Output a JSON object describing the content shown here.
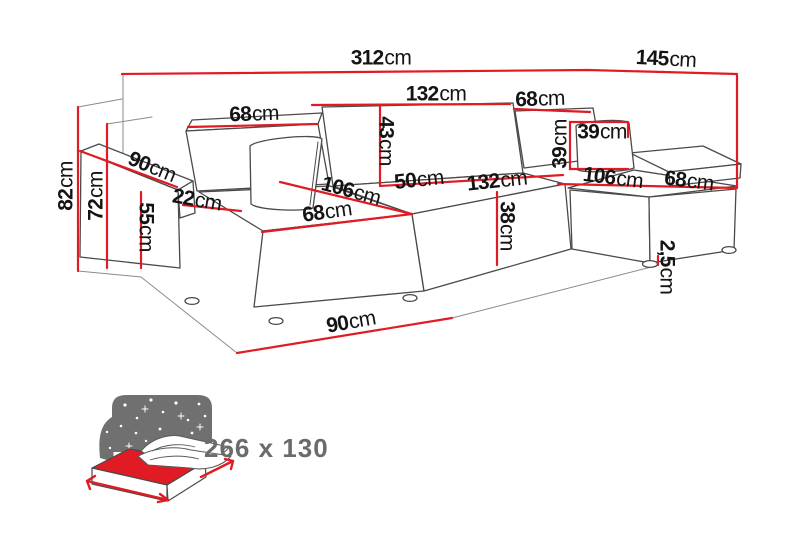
{
  "diagram": {
    "title": "corner-sofa-dimension-diagram",
    "unit_default": "cm",
    "labels": [
      {
        "id": "total-width",
        "value": "312",
        "unit": "cm",
        "x": 381,
        "y": 58,
        "rotate": 0
      },
      {
        "id": "total-depth-right",
        "value": "145",
        "unit": "cm",
        "x": 666,
        "y": 59,
        "rotate": 3
      },
      {
        "id": "back-cushion-middle-width",
        "value": "132",
        "unit": "cm",
        "x": 436,
        "y": 94,
        "rotate": 0
      },
      {
        "id": "back-cushion-right-width",
        "value": "68",
        "unit": "cm",
        "x": 540,
        "y": 99,
        "rotate": -2
      },
      {
        "id": "back-cushion-left-width",
        "value": "68",
        "unit": "cm",
        "x": 254,
        "y": 114,
        "rotate": -2
      },
      {
        "id": "back-cushion-height",
        "value": "43",
        "unit": "cm",
        "x": 386,
        "y": 141,
        "rotate": 90
      },
      {
        "id": "pillow-height",
        "value": "39",
        "unit": "cm",
        "x": 560,
        "y": 144,
        "rotate": -90
      },
      {
        "id": "pillow-width",
        "value": "39",
        "unit": "cm",
        "x": 602,
        "y": 132,
        "rotate": 0
      },
      {
        "id": "armrest-depth",
        "value": "90",
        "unit": "cm",
        "x": 152,
        "y": 167,
        "rotate": 22
      },
      {
        "id": "armrest-front-width",
        "value": "22",
        "unit": "cm",
        "x": 197,
        "y": 200,
        "rotate": 10
      },
      {
        "id": "chaise-left-length",
        "value": "106",
        "unit": "cm",
        "x": 351,
        "y": 191,
        "rotate": 15
      },
      {
        "id": "seat-depth",
        "value": "50",
        "unit": "cm",
        "x": 419,
        "y": 180,
        "rotate": -6
      },
      {
        "id": "seat-middle-width",
        "value": "132",
        "unit": "cm",
        "x": 497,
        "y": 181,
        "rotate": -6
      },
      {
        "id": "chaise-right-length",
        "value": "106",
        "unit": "cm",
        "x": 613,
        "y": 178,
        "rotate": 7
      },
      {
        "id": "armrest-right-width",
        "value": "68",
        "unit": "cm",
        "x": 689,
        "y": 181,
        "rotate": 7
      },
      {
        "id": "seat-left-width",
        "value": "68",
        "unit": "cm",
        "x": 327,
        "y": 212,
        "rotate": -8
      },
      {
        "id": "seat-height",
        "value": "38",
        "unit": "cm",
        "x": 507,
        "y": 226,
        "rotate": 90
      },
      {
        "id": "armrest-height",
        "value": "55",
        "unit": "cm",
        "x": 146,
        "y": 227,
        "rotate": 90
      },
      {
        "id": "total-height",
        "value": "82",
        "unit": "cm",
        "x": 66,
        "y": 186,
        "rotate": -90
      },
      {
        "id": "backrest-height",
        "value": "72",
        "unit": "cm",
        "x": 96,
        "y": 196,
        "rotate": -90
      },
      {
        "id": "chaise-front-width",
        "value": "90",
        "unit": "cm",
        "x": 351,
        "y": 322,
        "rotate": -10
      },
      {
        "id": "leg-height",
        "value": "2,5",
        "unit": "cm",
        "x": 667,
        "y": 267,
        "rotate": 90
      }
    ]
  },
  "sleeping_area": {
    "label": "266 x 130"
  },
  "colors": {
    "dimension_red": "#e11b23",
    "line_gray": "#4a4a4a",
    "icon_gray": "#707070",
    "text_black": "#141414",
    "sleeping_text_gray": "#6b6b6b"
  }
}
